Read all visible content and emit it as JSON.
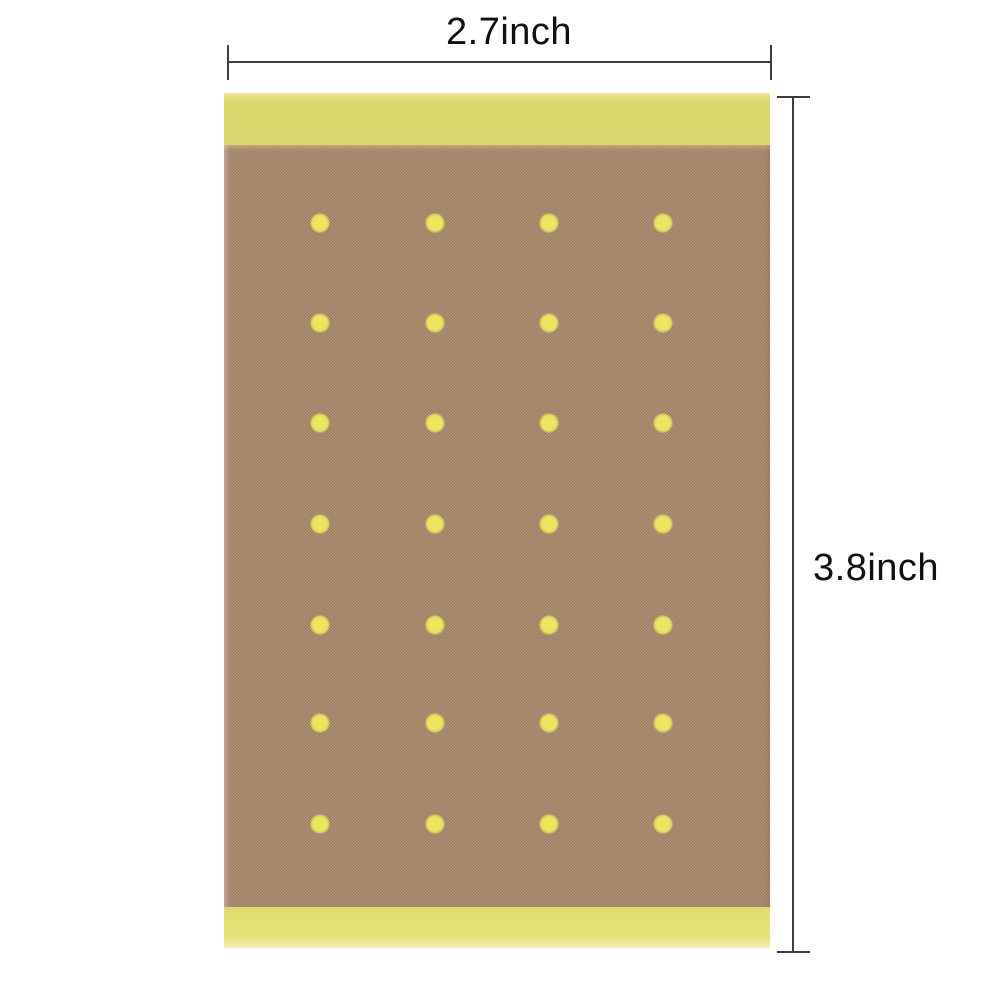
{
  "image": {
    "type": "product-dimension-photo",
    "subject": "perforated adhesive plaster patch (pain relief patch)",
    "background_color": "#ffffff"
  },
  "dimensions": {
    "width_label": "2.7inch",
    "height_label": "3.8inch",
    "line_color": "#3d3d3d",
    "text_color": "#101010"
  },
  "patch": {
    "top_band_color": "#dbd86d",
    "bottom_band_color": "#e4df72",
    "band_highlight_color": "#eceb9c",
    "fabric_color": "#a8896d",
    "fabric_weave_light": "#b19377",
    "fabric_weave_dark": "#9a7d62",
    "hole_color": "#ebe65e",
    "holes": {
      "rows": 7,
      "cols": 4,
      "count": 28
    }
  }
}
